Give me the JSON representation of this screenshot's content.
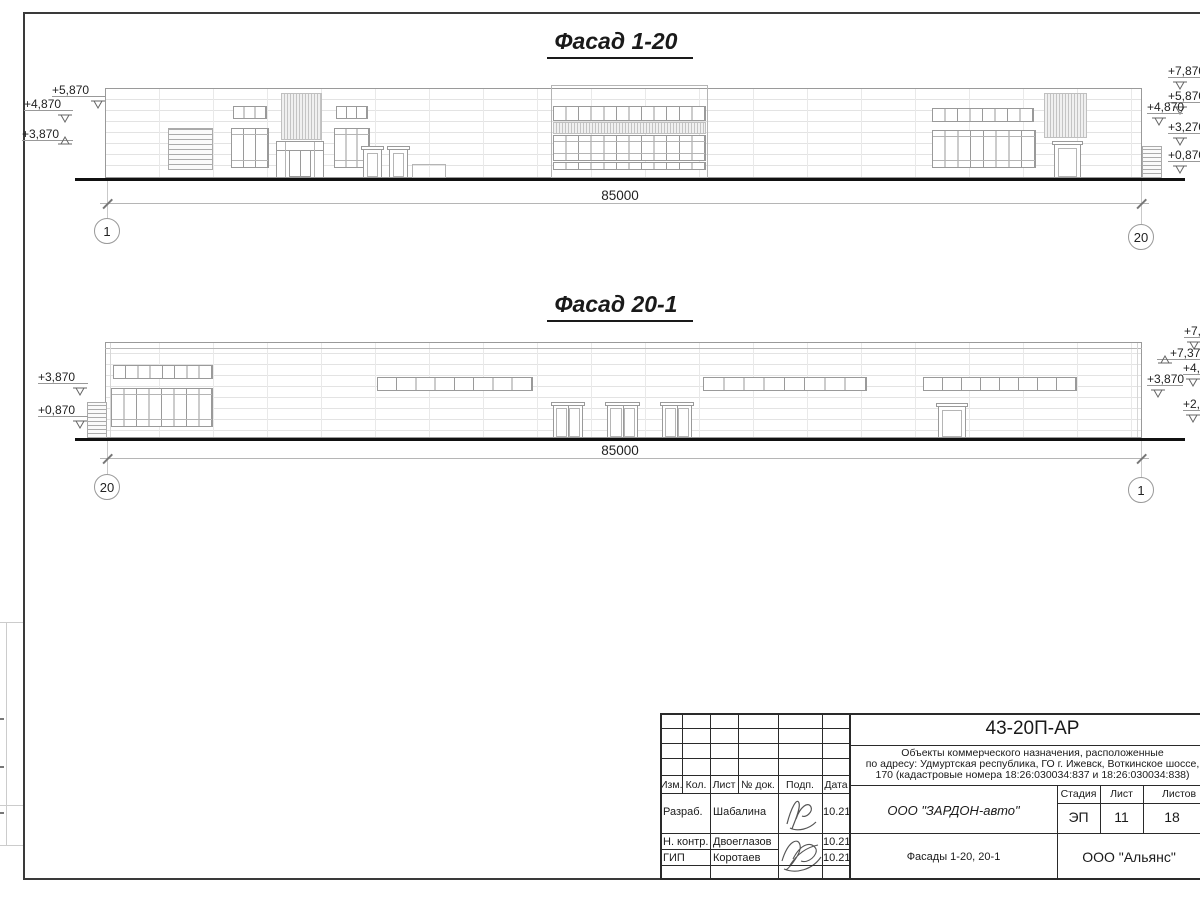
{
  "sheet": {
    "facades": [
      {
        "title": "Фасад 1-20",
        "dimension_label": "85000",
        "axis_left": "1",
        "axis_right": "20",
        "elevation_marks": [
          {
            "label": "+5,870",
            "x": 52,
            "y": 83,
            "mx": 90,
            "dir": "down"
          },
          {
            "label": "+4,870",
            "x": 24,
            "y": 97,
            "mx": 57,
            "dir": "down"
          },
          {
            "label": "+3,870",
            "x": 22,
            "y": 127,
            "mx": 57,
            "dir": "up"
          },
          {
            "label": "+7,870",
            "x": 1168,
            "y": 64,
            "mx": 1172,
            "dir": "down"
          },
          {
            "label": "+5,870",
            "x": 1168,
            "y": 89,
            "mx": 1172,
            "dir": "down"
          },
          {
            "label": "+4,870",
            "x": 1147,
            "y": 100,
            "mx": 1151,
            "dir": "down"
          },
          {
            "label": "+3,270",
            "x": 1168,
            "y": 120,
            "mx": 1172,
            "dir": "down"
          },
          {
            "label": "+0,870",
            "x": 1168,
            "y": 148,
            "mx": 1172,
            "dir": "down"
          }
        ]
      },
      {
        "title": "Фасад 20-1",
        "dimension_label": "85000",
        "axis_left": "20",
        "axis_right": "1",
        "elevation_marks": [
          {
            "label": "+3,870",
            "x": 38,
            "y": 370,
            "mx": 72,
            "dir": "down"
          },
          {
            "label": "+0,870",
            "x": 38,
            "y": 403,
            "mx": 72,
            "dir": "down"
          },
          {
            "label": "+7,870",
            "x": 1184,
            "y": 324,
            "mx": 1186,
            "dir": "down"
          },
          {
            "label": "+7,370",
            "x": 1170,
            "y": 346,
            "mx": 1157,
            "dir": "up"
          },
          {
            "label": "+4,870",
            "x": 1183,
            "y": 361,
            "mx": 1185,
            "dir": "down"
          },
          {
            "label": "+3,870",
            "x": 1147,
            "y": 372,
            "mx": 1150,
            "dir": "down"
          },
          {
            "label": "+2,170",
            "x": 1183,
            "y": 397,
            "mx": 1185,
            "dir": "down"
          }
        ]
      }
    ]
  },
  "titleblock": {
    "doc_code": "43-20П-АР",
    "description_lines": [
      "Объекты коммерческого назначения, расположенные",
      "по адресу: Удмуртская республика, ГО г. Ижевск, Воткинское шоссе,",
      "170 (кадастровые номера 18:26:030034:837 и 18:26:030034:838)"
    ],
    "columns": [
      "Изм.",
      "Кол.",
      "Лист",
      "№ док.",
      "Подп.",
      "Дата"
    ],
    "rows": [
      {
        "role": "Разраб.",
        "name": "Шабалина",
        "date": "10.21"
      },
      {
        "role": "Н. контр.",
        "name": "Двоеглазов",
        "date": "10.21"
      },
      {
        "role": "ГИП",
        "name": "Коротаев",
        "date": "10.21"
      }
    ],
    "company": "ООО \"ЗАРДОН-авто\"",
    "drawing_title": "Фасады 1-20, 20-1",
    "organization": "ООО \"Альянс\"",
    "stage_label": "Стадия",
    "sheet_label": "Лист",
    "sheets_label": "Листов",
    "stage_value": "ЭП",
    "sheet_value": "11",
    "sheets_value": "18"
  }
}
